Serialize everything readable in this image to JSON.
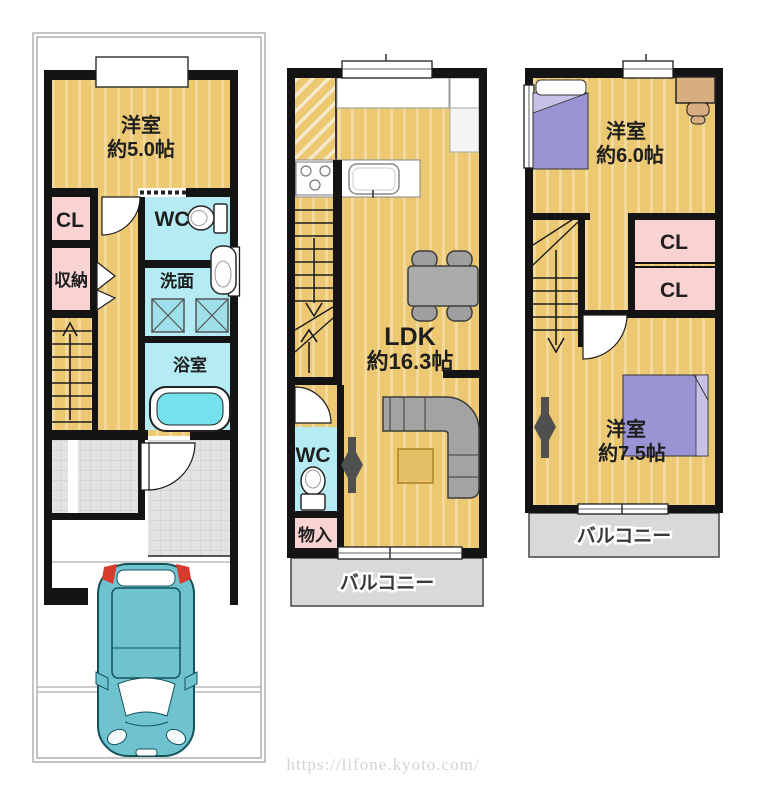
{
  "watermark": "https://lifone.kyoto.com/",
  "floor1": {
    "western_room_name": "洋室",
    "western_room_size": "約5.0帖",
    "closet": "CL",
    "toilet": "WC",
    "storage": "収納",
    "washroom": "洗面",
    "bathroom": "浴室"
  },
  "floor2": {
    "ldk_name": "LDK",
    "ldk_size": "約16.3帖",
    "toilet": "WC",
    "storage": "物入",
    "balcony": "バルコニー"
  },
  "floor3": {
    "room6_name": "洋室",
    "room6_size": "約6.0帖",
    "closet_upper": "CL",
    "closet_lower": "CL",
    "room75_name": "洋室",
    "room75_size": "約7.5帖",
    "balcony": "バルコニー"
  },
  "colors": {
    "floor_tan": "#ecc873",
    "floor_stripe": "#f3d99b",
    "room_pink": "#f9d2d2",
    "room_cyan": "#b5ebf2",
    "balcony_gray": "#d9d9d9",
    "wall_black": "#141414",
    "car_teal": "#6fc3cf",
    "bed_purple": "#9a94d5",
    "desk_tan": "#d8ad82"
  }
}
